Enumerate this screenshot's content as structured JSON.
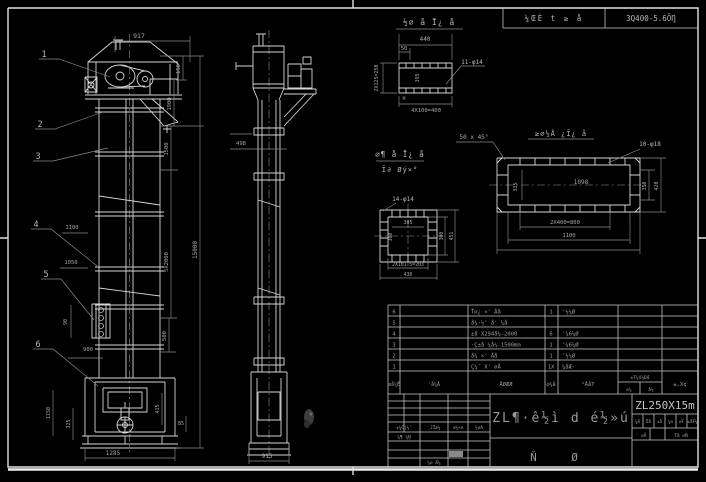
{
  "colors": {
    "background": "#000000",
    "line": "#d6d6d6",
    "dim_line": "#8b8b8b",
    "dim_text": "#a8a8a8",
    "label_text": "#b8b8b8",
    "frame": "#e2e2e2"
  },
  "header_table": {
    "project": "¼ŒÈ t ≥ å",
    "spec": "3Q400-5.6ŌŊ"
  },
  "front_view": {
    "balloons": [
      "1",
      "2",
      "3",
      "4",
      "5",
      "6"
    ],
    "dim_917": "917",
    "dim_150": "150",
    "dim_1900": "1900",
    "dim_1500": "1500",
    "dim_5x2000": "5X2000",
    "dim_15000": "15000",
    "dim_500": "500",
    "dim_1100": "1100",
    "dim_1050": "1050",
    "dim_90": "90",
    "dim_900": "900",
    "dim_1150": "1150",
    "dim_325": "325",
    "dim_415": "415",
    "dim_85": "85",
    "dim_1285": "1285"
  },
  "side_view": {
    "dim_498": "498",
    "dim_915": "915"
  },
  "detail_channel": {
    "title": "½∅ å Ī¿ å",
    "dim_440": "440",
    "dim_50": "50",
    "holes": "11-φ14",
    "dim_left": "2X125=250",
    "dim_inner": "395",
    "weld": "M",
    "dim_bottom": "4X100=400"
  },
  "detail_square": {
    "holes": "14-φ14",
    "dim_top": "305",
    "dim_left": "300",
    "dim_right1": "300",
    "dim_right2": "451",
    "dim_bottom1": "2X101.5=203",
    "dim_bottom2": "430"
  },
  "detail_plate": {
    "title": "≥∅½Å ¿Ī¿ å",
    "chamfer": "50 x 45°",
    "holes": "10-φ18",
    "dim_inner": "1098",
    "dim_left": "335",
    "dim_bottom1": "2X400=800",
    "dim_bottom2": "1100",
    "dim_right1": "350",
    "dim_right2": "420"
  },
  "mid_label": {
    "line1": "∅¶ å Ī¿ å",
    "line2": "Ī∂ Øý×°"
  },
  "bom": {
    "headers": {
      "no": "∅å¼Ě",
      "code": "'å¼Å",
      "name": "ÅØÆÆ",
      "qty": "∅¼å",
      "material": "²ÅåT",
      "weight": "±Ŧ¼X¼ĐÆ",
      "weight_sub1": "∅¼",
      "weight_sub2": "å¼",
      "remark": "±,X¢"
    },
    "rows": [
      {
        "no": "6",
        "name": "Ť∅¿ ×' Åå",
        "qty": "1",
        "material": "'½¼Ø"
      },
      {
        "no": "5",
        "name": "å¼·½ʼ å' ¼å",
        "qty": "",
        "material": ""
      },
      {
        "no": "4",
        "name": "±å X294å¼-2000",
        "qty": "6",
        "material": "'¼6¼Ø"
      },
      {
        "no": "3",
        "name": "·Ç±å ¼å¼-1500mm",
        "qty": "1",
        "material": "'¼6¼Ø"
      },
      {
        "no": "2",
        "name": "å¼ ×' Åå",
        "qty": "1",
        "material": "'½¼Ø"
      },
      {
        "no": "1",
        "name": "Ç¼˝ X' ∅Å",
        "qty": "1X",
        "material": "¼åÆ·"
      }
    ]
  },
  "title_block": {
    "big_title": "ZL¶·ê½ì d é½»ú",
    "model": "ZL250X15m",
    "assembly": "Ň Ø",
    "sig_row": [
      "±¼Ĉ|¼'",
      "¸JĪæ¼",
      "∅¼×∅",
      "¼∅å"
    ],
    "left_label1": "¼¶ ¼Ņ",
    "left_label2": "¼∅ Æ¼",
    "stage_cells": [
      "¼Æ",
      "Ďå",
      "±å",
      "¼∅",
      "∅Ŧ",
      "±åŦ¼"
    ],
    "sheet_left": "' ∅Å",
    "sheet_right": "Ŧå ∅Ň"
  }
}
